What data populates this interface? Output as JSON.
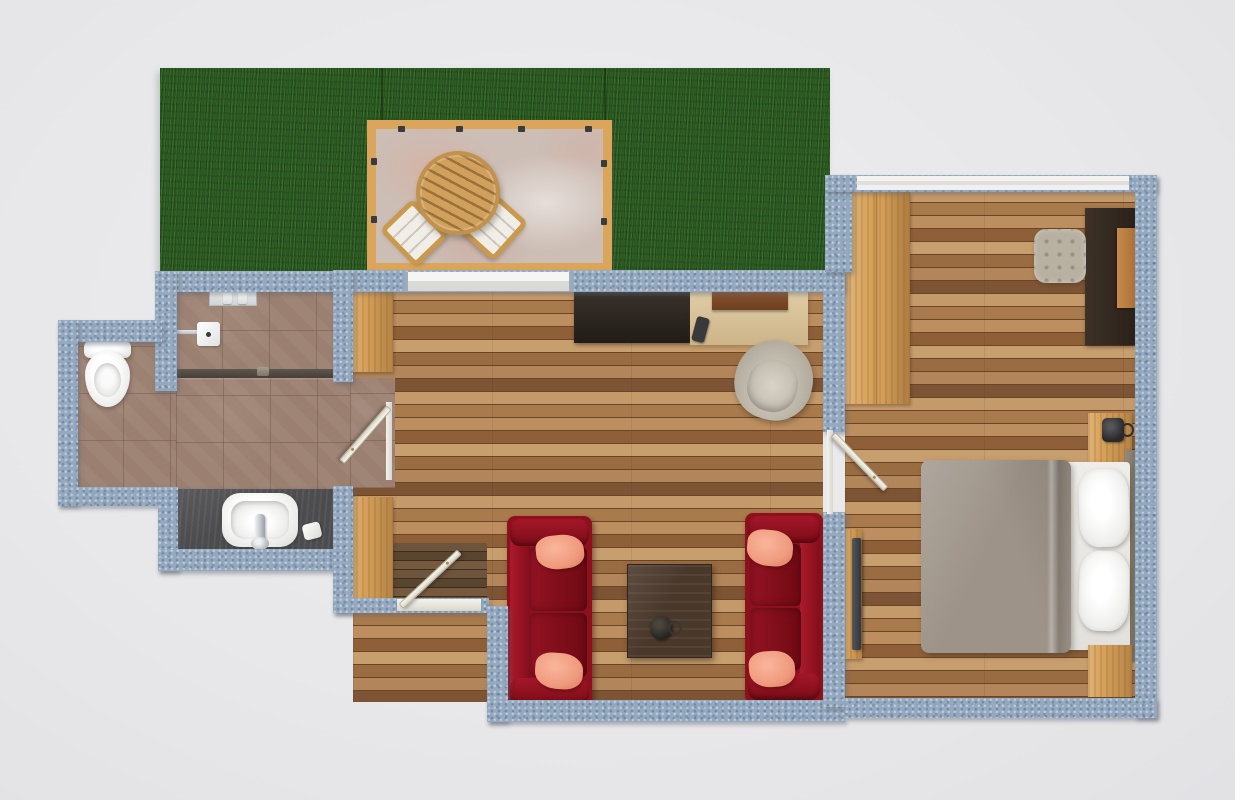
{
  "scene": {
    "type": "apartment-floor-plan",
    "view": "top-down 3d render",
    "visible_text": "none"
  },
  "colors": {
    "background": "#e8e8ea",
    "wall": "#94a9bf",
    "grass": "#2e5c24",
    "terrace_wood": "#dca55c",
    "terrace_stone": "#ccbdb5",
    "floor_wood": "#b08254",
    "entry_mat": "#5a4431",
    "bath_tile": "#9f8576",
    "counter_slate": "#4c4b4e",
    "fixture_white": "#f5f4f2",
    "sofa_red": "#8e101d",
    "pillow_salmon": "#f09a7e",
    "coffee_table": "#4a382b",
    "sideboard_dark": "#292119",
    "desk_pale_wood": "#d8c298",
    "office_chair_gray": "#b7b1a5",
    "furniture_oak": "#d8a35c",
    "bed_blanket": "#9d9388",
    "bedroom_desk_dark": "#352b22",
    "tv_dark": "#42464a",
    "door_white": "#f2efe2"
  },
  "rooms": [
    {
      "id": "garden",
      "name": "Garden",
      "features": [
        "lawn",
        "wood-framed terrace",
        "round slatted table",
        "two outdoor chairs with white cushions"
      ]
    },
    {
      "id": "living-room",
      "name": "Living room",
      "features": [
        "sliding glass door to terrace",
        "dark sideboard",
        "pale wood desk with board and remote",
        "office chair",
        "two red sofas with salmon throw pillows",
        "dark coffee table with mug",
        "two oak wardrobes",
        "entry door with dark mat"
      ]
    },
    {
      "id": "bathroom",
      "name": "Bathroom",
      "features": [
        "toilet",
        "walk-in shower with drain, head plate and shelf bottles",
        "slate vanity with white vessel sink, faucet and soap"
      ]
    },
    {
      "id": "bedroom",
      "name": "Bedroom",
      "features": [
        "double bed with taupe blanket and two pillows",
        "two wood nightstands with dark mug",
        "tall oak wardrobe",
        "dark desk with wood chair",
        "quilted stool",
        "wall-mounted TV on wood board",
        "window strip on top wall"
      ]
    }
  ]
}
